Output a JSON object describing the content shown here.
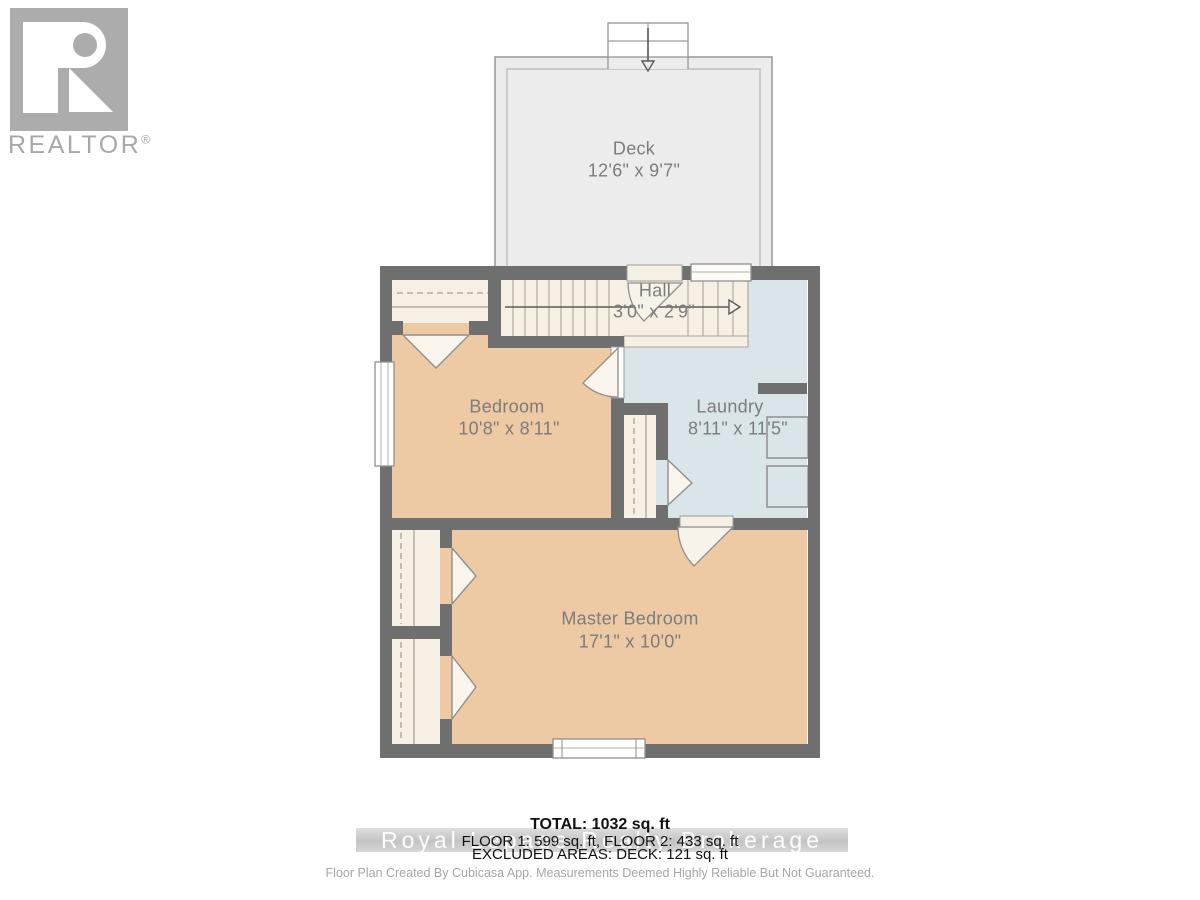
{
  "branding": {
    "logo_monogram": "R",
    "logo_wordmark": "REALTOR",
    "registered_symbol": "®"
  },
  "floorplan": {
    "rooms": [
      {
        "id": "deck",
        "name": "Deck",
        "dimensions": "12'6\" x 9'7\""
      },
      {
        "id": "hall",
        "name": "Hall",
        "dimensions": "3'0\" x 2'9\""
      },
      {
        "id": "bedroom",
        "name": "Bedroom",
        "dimensions": "10'8\" x 8'11\""
      },
      {
        "id": "laundry",
        "name": "Laundry",
        "dimensions": "8'11\" x 11'5\""
      },
      {
        "id": "master-bedroom",
        "name": "Master Bedroom",
        "dimensions": "17'1\" x 10'0\""
      }
    ],
    "colors": {
      "wall": "#6f6f6f",
      "room_fill_tan": "#edc9a4",
      "laundry_fill_blue": "#d9e5e8",
      "stairs_fill_cream": "#f6f0e4",
      "deck_fill": "#ececec",
      "label_text": "#7c7c7c"
    }
  },
  "summary": {
    "total": "TOTAL: 1032 sq. ft",
    "floors": "FLOOR 1: 599 sq. ft, FLOOR 2: 433 sq. ft",
    "excluded_areas": "EXCLUDED AREAS: DECK: 121 sq. ft"
  },
  "watermark": {
    "text": "Royal Lepage Realty Brokerage"
  },
  "disclaimer": "Floor Plan Created By Cubicasa App. Measurements Deemed Highly Reliable But Not Guaranteed."
}
